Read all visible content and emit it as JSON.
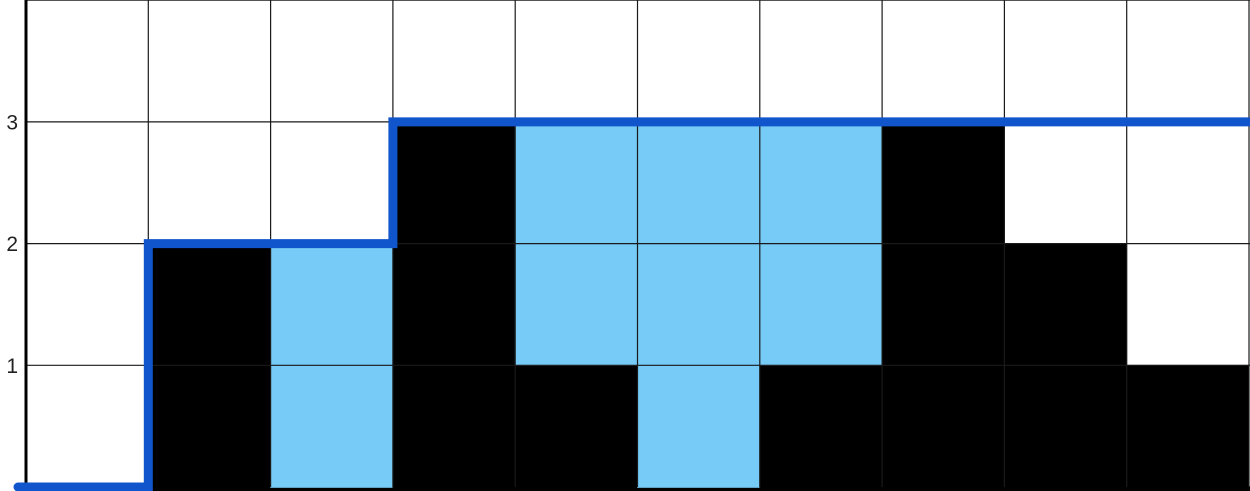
{
  "page": {
    "background_color": "#ffffff"
  },
  "chart_data": {
    "type": "bar",
    "subtype": "trapping-rain-water-grid",
    "title": "",
    "xlabel": "",
    "ylabel": "",
    "columns": 10,
    "rows_visible": 4,
    "ylim": [
      0,
      4
    ],
    "grid": true,
    "y_ticks": [
      "1",
      "2",
      "3"
    ],
    "y_tick_values": [
      1,
      2,
      3
    ],
    "bar_heights": [
      0,
      2,
      0,
      3,
      1,
      0,
      1,
      3,
      2,
      1
    ],
    "water_heights": [
      0,
      0,
      2,
      0,
      2,
      3,
      2,
      0,
      0,
      0
    ],
    "running_max_levels": [
      0,
      2,
      2,
      3,
      3,
      3,
      3,
      3,
      3,
      3
    ],
    "colors": {
      "elevation_bar": "#000000",
      "water_cell": "#76CBF7",
      "running_max_line": "#1155CC",
      "gridline": "#1a1a1a",
      "axis": "#000000",
      "tick_label": "#222222",
      "background": "#ffffff"
    }
  }
}
